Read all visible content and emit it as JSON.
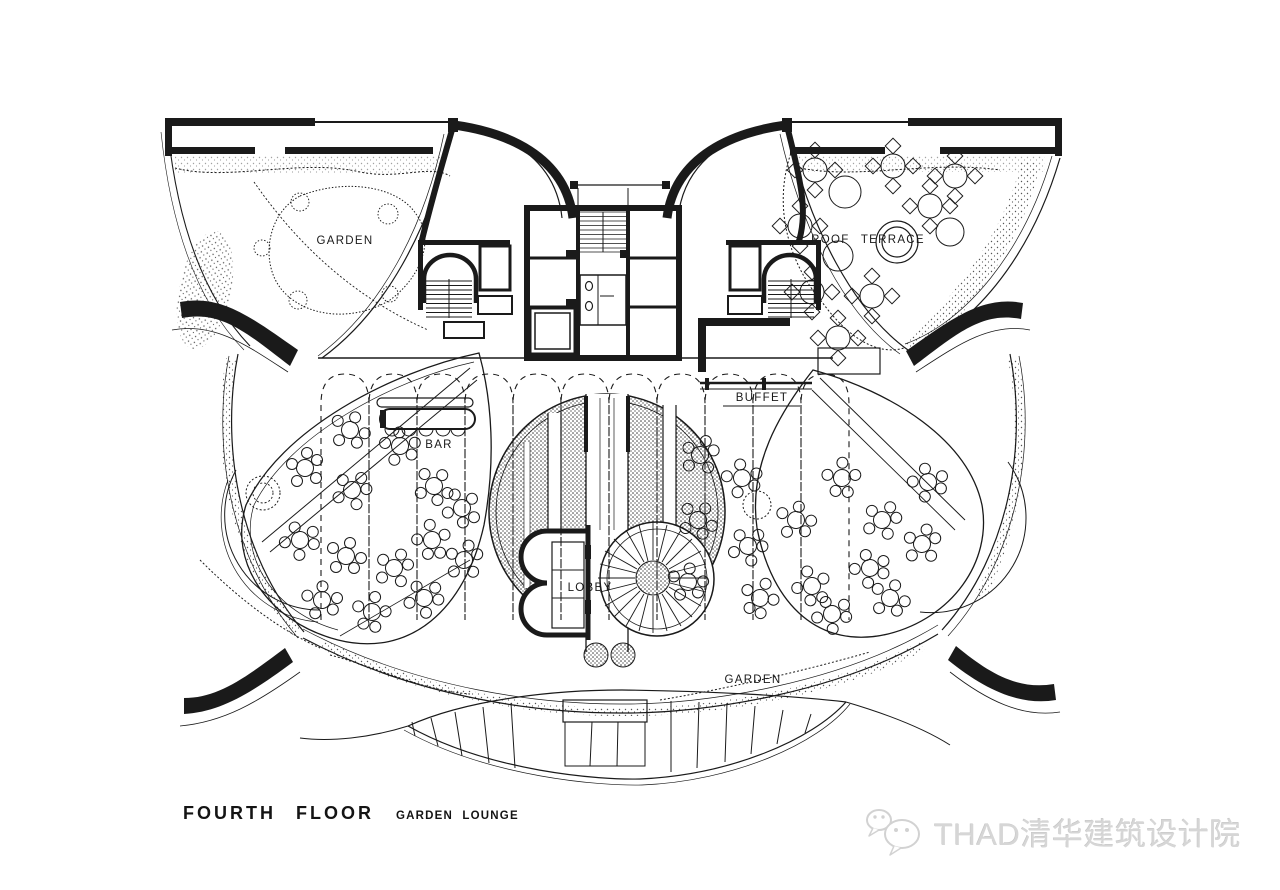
{
  "title": {
    "floor": "FOURTH FLOOR",
    "room": "GARDEN LOUNGE"
  },
  "plan": {
    "labels": {
      "garden_top": "GARDEN",
      "roof_terrace": "ROOF TERRACE",
      "buffet": "BUFFET",
      "bar": "BAR",
      "lobby": "LOBBY",
      "garden_bottom": "GARDEN"
    }
  },
  "watermark": {
    "text": "THAD清华建筑设计院",
    "icon": "wechat-speech-bubbles"
  },
  "colors": {
    "ink": "#1a1a1a",
    "paper": "#ffffff",
    "watermark_gray": "#d6d6d6"
  }
}
